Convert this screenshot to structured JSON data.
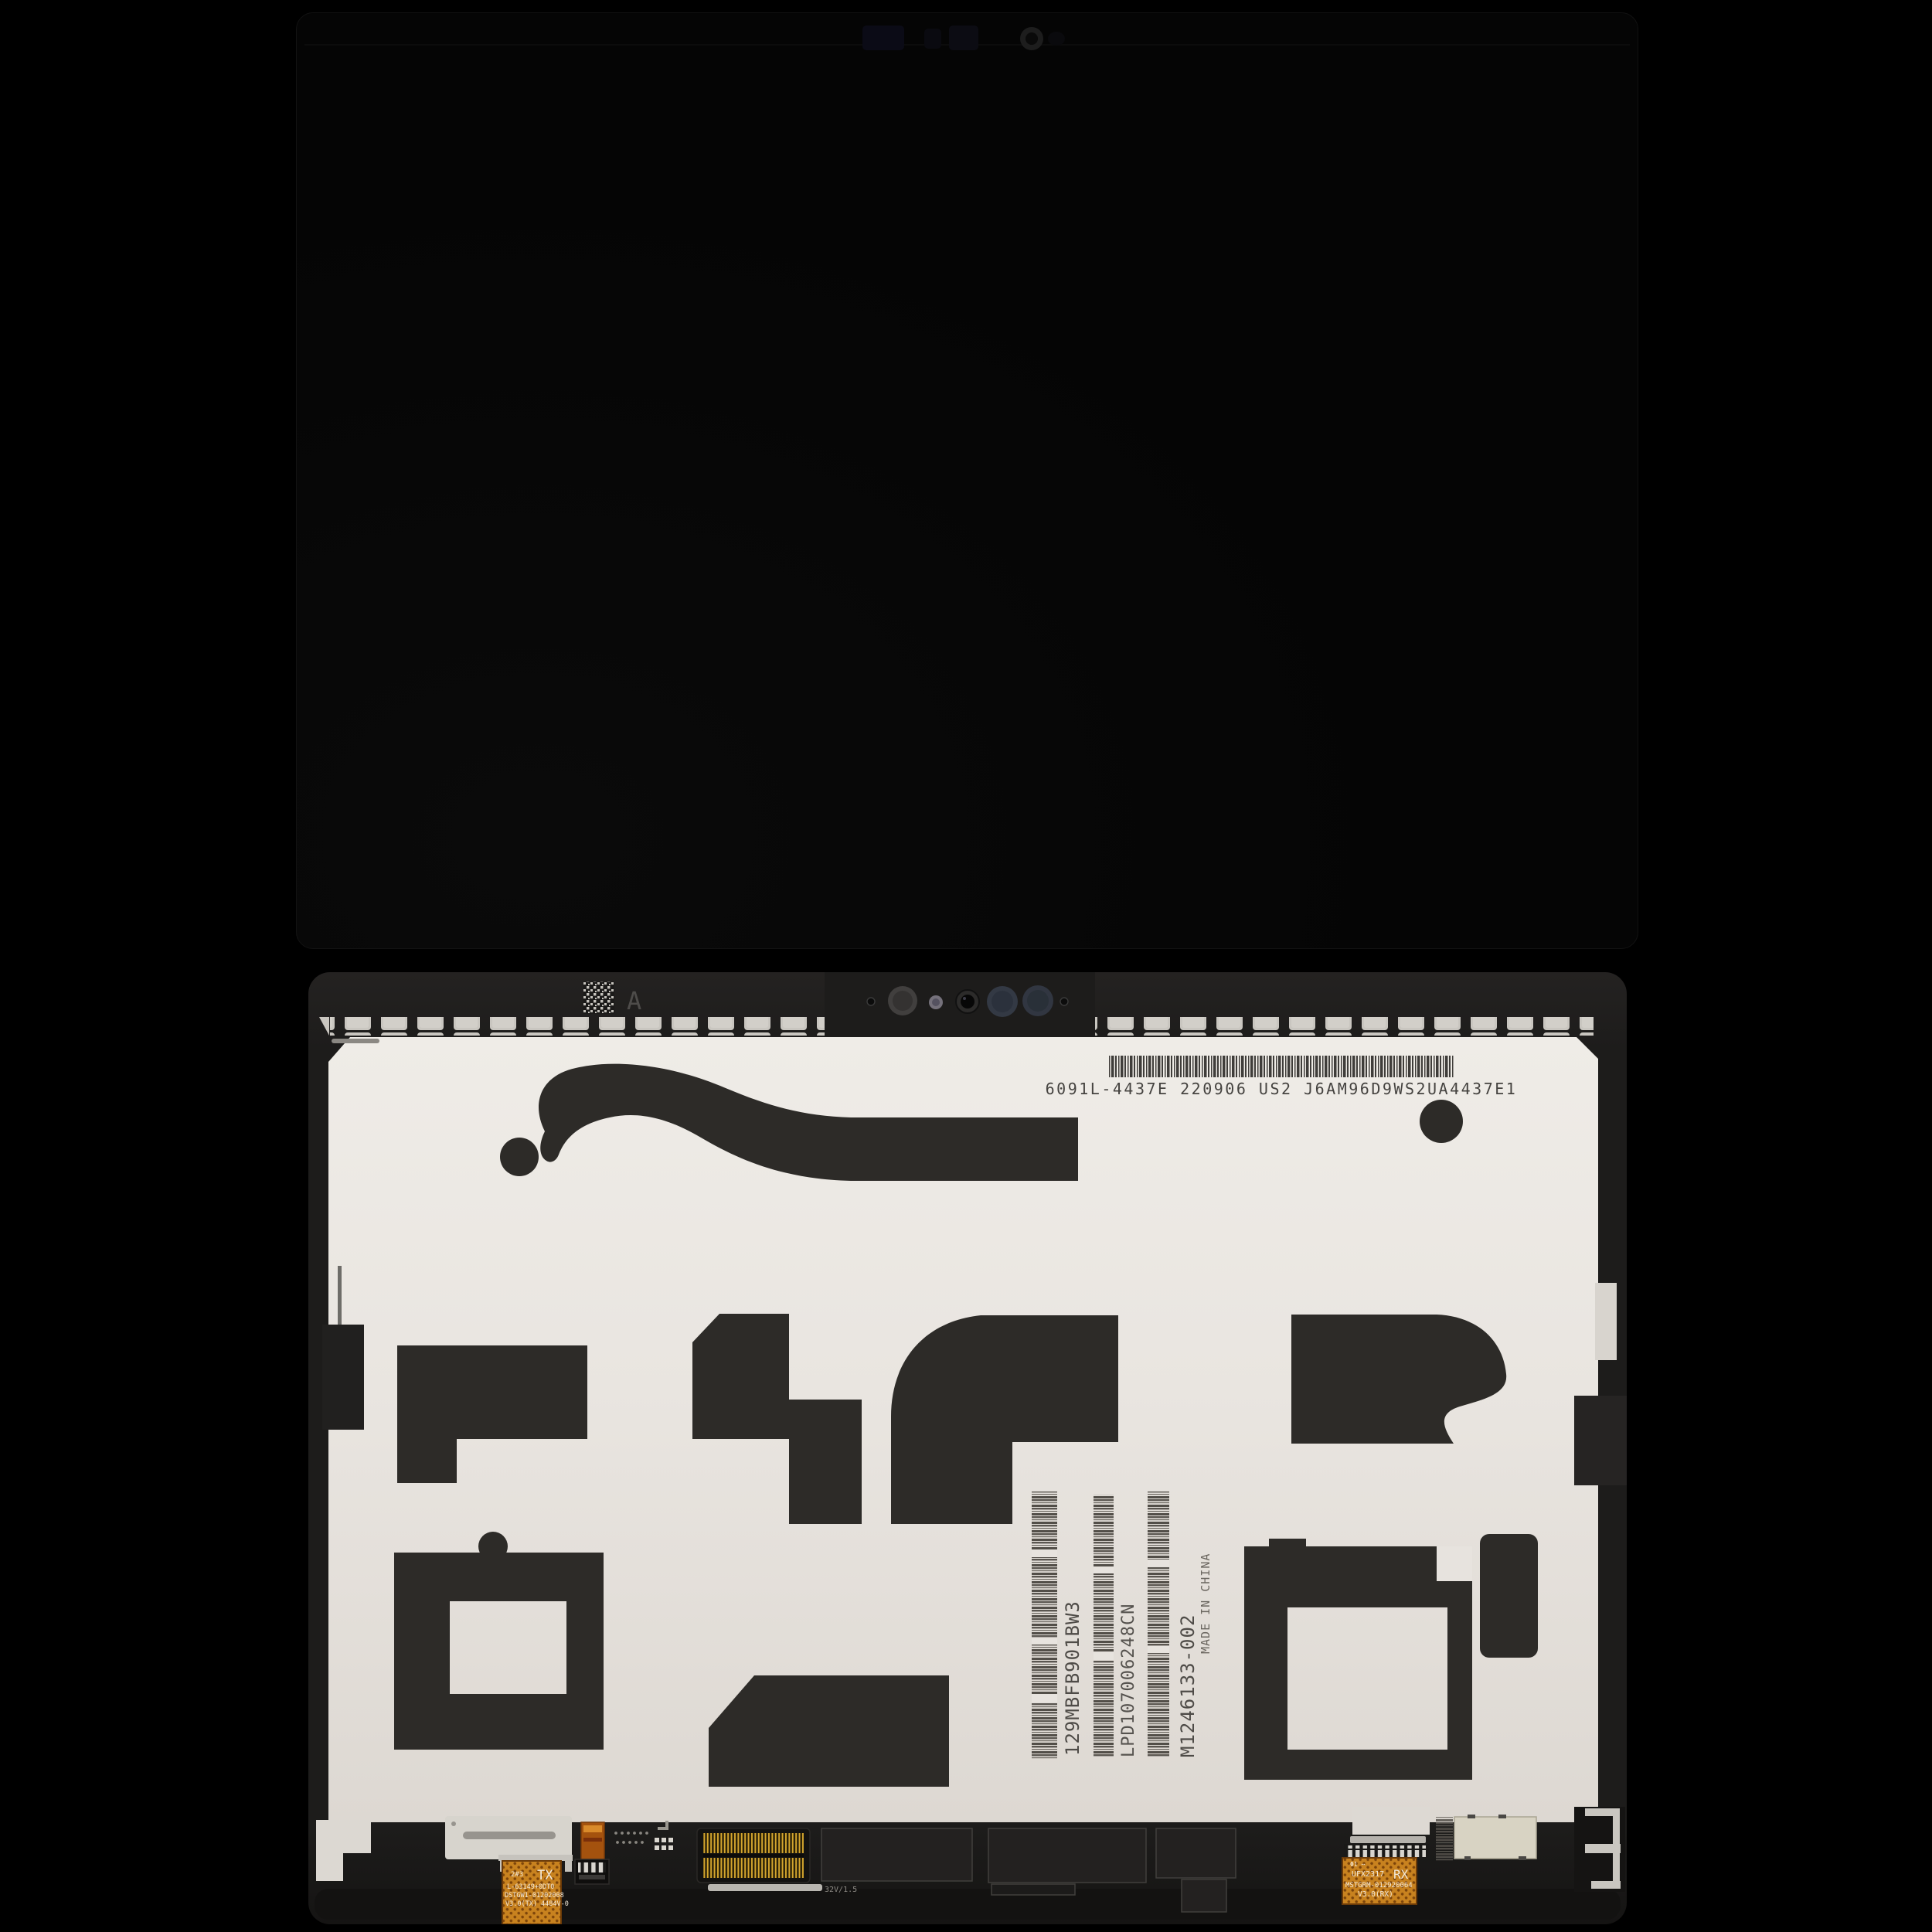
{
  "scene": {
    "description": "Tablet LCD display assembly replacement part photographed front (black glass) and back (adhesive backing with labels and flex cables)",
    "background_color": "#000000"
  },
  "front_panel": {
    "label": "display-front-glass-off"
  },
  "back_panel": {
    "top_label": {
      "barcode_text": "6091L-4437E 220906 US2 J6AM96D9WS2UA4437E1",
      "datamatrix_label": "A"
    },
    "serial_labels": {
      "col1": "129MBFB901BW3",
      "col2": "LPD107006248CN",
      "col3": "M1246133-002",
      "origin": "MADE IN CHINA"
    },
    "tx_flex": {
      "l1a": "2#3",
      "l1b": "TX",
      "l2": "L-63149+0DT0",
      "l3": "DSTGW1-01202008",
      "l4": "V3.0(TX) 4484V-0"
    },
    "rx_flex": {
      "l1": "Φ1 ⋯",
      "l2a": "UFX2317",
      "l2b": "RX",
      "l3": "MSTGRM-012920064",
      "l4": "V3.0(RX)"
    },
    "connector_label": "32V/1.5",
    "colors": {
      "backing": "#e9e5e0",
      "adhesive": "#2d2b28",
      "flex_orange": "#c8821f",
      "bezel": "#1d1c1b",
      "perforation": "#c9c6c0",
      "gold_pins": "#d4a52e"
    }
  }
}
